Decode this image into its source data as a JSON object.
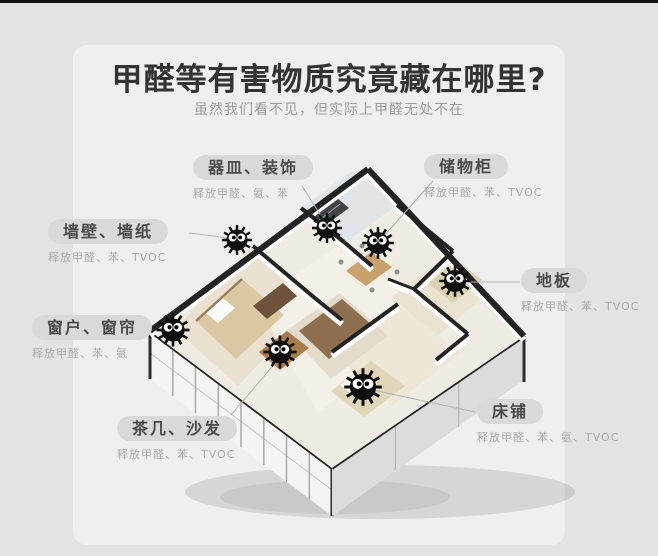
{
  "page": {
    "title": "甲醛等有害物质究竟藏在哪里?",
    "subtitle": "虽然我们看不见，但实际上甲醛无处不在"
  },
  "callouts": [
    {
      "id": "vessels-decor",
      "label": "器皿、装饰",
      "sublabel": "释放甲醛、氨、苯"
    },
    {
      "id": "storage-cabinet",
      "label": "储物柜",
      "sublabel": "释放甲醛、苯、TVOC"
    },
    {
      "id": "wall-wallpaper",
      "label": "墙壁、墙纸",
      "sublabel": "释放甲醛、苯、TVOC"
    },
    {
      "id": "floor",
      "label": "地板",
      "sublabel": "释放甲醛、苯、TVOC"
    },
    {
      "id": "window-curtain",
      "label": "窗户、窗帘",
      "sublabel": "释放甲醛、苯、氨"
    },
    {
      "id": "tea-table-sofa",
      "label": "茶几、沙发",
      "sublabel": "释放甲醛、苯、TVOC"
    },
    {
      "id": "bed",
      "label": "床铺",
      "sublabel": "释放甲醛、苯、氨、TVOC"
    }
  ],
  "illustration": {
    "type": "isometric-3d-apartment-render",
    "soot_sprite_count": 7
  },
  "colors": {
    "background": "#e3e3e3",
    "panel": "#efefef",
    "top_bar": "#141414",
    "title_text": "#333333",
    "subtitle_text": "#9c9c9c",
    "pill_bg": "#d9d9d9",
    "pill_text": "#4a4a4a",
    "sublabel_text": "#a9a9a9",
    "callout_line": "#b3b3b3",
    "wall_top": "#232323",
    "soot_sprite": "#0f0f0f"
  }
}
